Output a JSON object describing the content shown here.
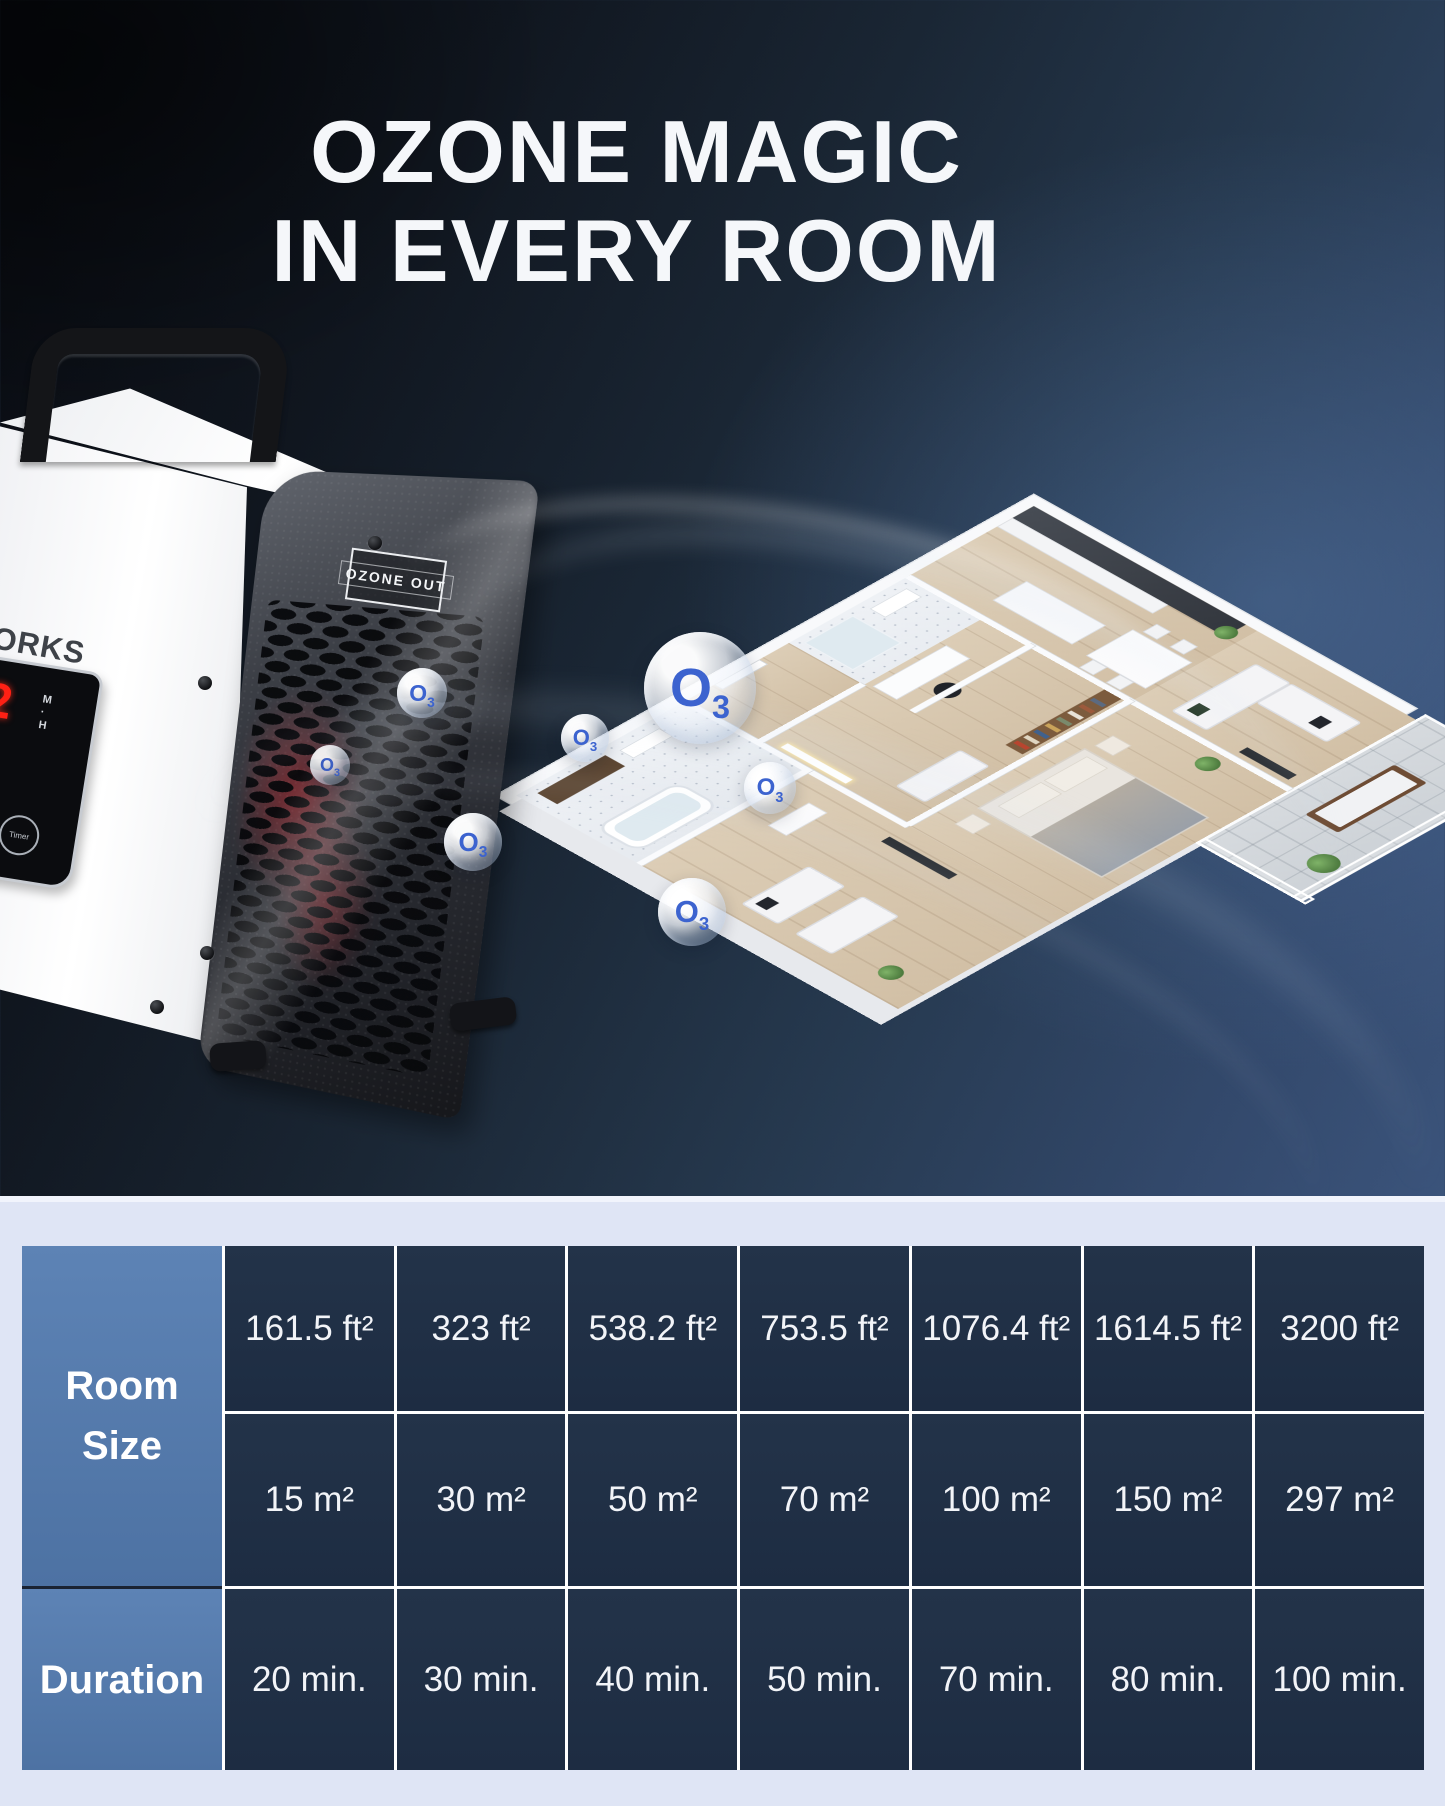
{
  "title": {
    "line1": "OZONE MAGIC",
    "line2": "IN EVERY ROOM"
  },
  "device": {
    "brand_partial": "ORKS",
    "outlet_label": "OZONE OUT",
    "timer_display": {
      "digit": "2",
      "minutes_abbr": "M",
      "separator": "·",
      "hours_abbr": "H"
    },
    "timer_button_label": "Timer"
  },
  "ozone_symbol": {
    "o": "O",
    "sub": "3"
  },
  "size_table": {
    "row_header_size_line1": "Room",
    "row_header_size_line2": "Size",
    "row_header_duration": "Duration",
    "columns": [
      {
        "imperial": "161.5 ft²",
        "metric": "15 m²",
        "duration": "20 min."
      },
      {
        "imperial": "323 ft²",
        "metric": "30 m²",
        "duration": "30 min."
      },
      {
        "imperial": "538.2 ft²",
        "metric": "50 m²",
        "duration": "40 min."
      },
      {
        "imperial": "753.5 ft²",
        "metric": "70 m²",
        "duration": "50 min."
      },
      {
        "imperial": "1076.4 ft²",
        "metric": "100 m²",
        "duration": "70 min."
      },
      {
        "imperial": "1614.5 ft²",
        "metric": "150 m²",
        "duration": "80 min."
      },
      {
        "imperial": "3200 ft²",
        "metric": "297 m²",
        "duration": "100 min."
      }
    ]
  },
  "colors": {
    "background_dark": "#10161f",
    "background_light_blue": "#44608c",
    "ozone_blue": "#3c63cf",
    "table_header_cell": "#5d83b5",
    "table_data_cell": "#1f2e47",
    "table_area_background": "#dfe5f5",
    "glow_red": "#d02026"
  }
}
